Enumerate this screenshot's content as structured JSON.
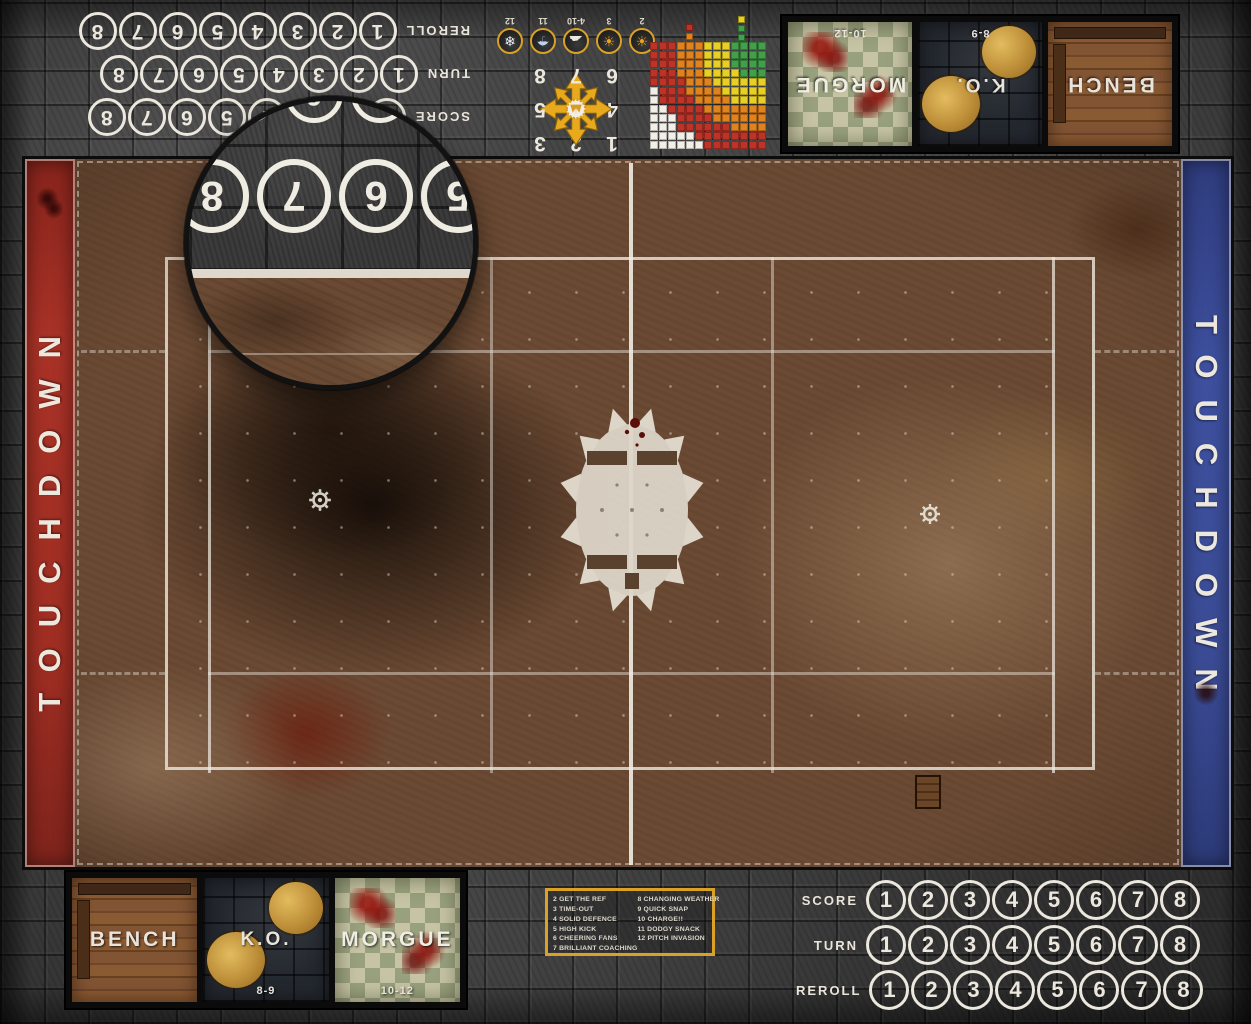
{
  "banners": {
    "left": "TOUCHDOWN",
    "right": "TOUCHDOWN",
    "left_color": "#a93227",
    "right_color": "#3e509f"
  },
  "counters": {
    "numbers": [
      "1",
      "2",
      "3",
      "4",
      "5",
      "6",
      "7",
      "8"
    ],
    "top_left_rows": [
      "REROLL",
      "TURN",
      "SCORE"
    ],
    "bottom_right_rows": [
      "SCORE",
      "TURN",
      "REROLL"
    ]
  },
  "weather": {
    "items": [
      {
        "label": "2",
        "icon": "sun-icon",
        "glyph": "☀"
      },
      {
        "label": "3",
        "icon": "sunny-cloud-icon",
        "glyph": "☀"
      },
      {
        "label": "4-10",
        "icon": "partly-cloudy-icon",
        "glyph": "☁"
      },
      {
        "label": "11",
        "icon": "rain-cloud-icon",
        "glyph": "☂"
      },
      {
        "label": "12",
        "icon": "snow-cloud-icon",
        "glyph": "❄"
      }
    ]
  },
  "scatter": {
    "grid": [
      "1",
      "2",
      "3",
      "4",
      "",
      "5",
      "6",
      "7",
      "8"
    ],
    "arrow_color": "#e8a91c"
  },
  "range_chart": {
    "cols": 13,
    "rows": 12,
    "bands": [
      {
        "r": 3.8,
        "color": "#43a04a"
      },
      {
        "r": 6.8,
        "color": "#e8cf25"
      },
      {
        "r": 9.8,
        "color": "#e2821c"
      },
      {
        "r": 12.8,
        "color": "#bf3226"
      }
    ],
    "out_color": "#f2efe8",
    "legend_left": [
      "#bf3226",
      "#e2821c"
    ],
    "legend_right": [
      "#e8cf25",
      "#43a04a",
      "#43a04a"
    ]
  },
  "dugouts": {
    "top": [
      {
        "label": "MORGUE",
        "range": "10-12",
        "surface": "checker"
      },
      {
        "label": "K.O.",
        "range": "8-9",
        "surface": "stone"
      },
      {
        "label": "BENCH",
        "range": "",
        "surface": "wood"
      }
    ],
    "bottom": [
      {
        "label": "BENCH",
        "range": "",
        "surface": "wood"
      },
      {
        "label": "K.O.",
        "range": "8-9",
        "surface": "stone"
      },
      {
        "label": "MORGUE",
        "range": "10-12",
        "surface": "checker"
      }
    ]
  },
  "kickoff": {
    "border_color": "#d9a126",
    "left": [
      "2 GET THE REF",
      "3 TIME-OUT",
      "4 SOLID DEFENCE",
      "5 HIGH KICK",
      "6 CHEERING FANS",
      "7 BRILLIANT COACHING"
    ],
    "right": [
      "8 CHANGING WEATHER",
      "9 QUICK SNAP",
      "10 CHARGE!!",
      "11 DODGY SNACK",
      "12 PITCH INVASION"
    ]
  },
  "magnifier": {
    "numbers": [
      "5",
      "6",
      "7",
      "8"
    ],
    "partial_numbers": [
      "5",
      "6",
      "7"
    ]
  }
}
